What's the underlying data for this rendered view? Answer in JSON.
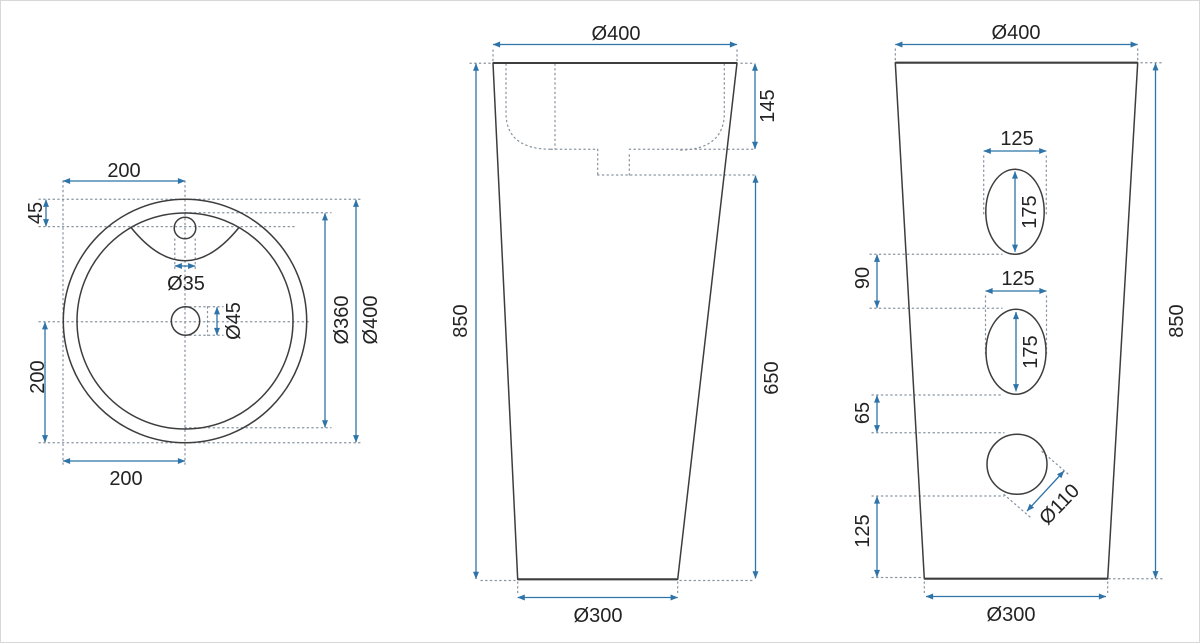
{
  "drawing": {
    "title": "Pedestal washbasin technical drawing, three views with dimensions (mm)",
    "colors": {
      "dimension_blue": "#2f74a8",
      "outline_dark": "#3d3d3d",
      "hidden_dotted_gray": "#8894a0",
      "text_black": "#232323",
      "background": "#ffffff"
    },
    "top_view": {
      "width_top": "200",
      "faucet_offset": "45",
      "faucet_hole": "Ø35",
      "drain_hole": "Ø45",
      "height_left": "200",
      "width_bottom": "200",
      "inner_diameter": "Ø360",
      "outer_diameter": "Ø400"
    },
    "front_view": {
      "top_diameter": "Ø400",
      "basin_depth": "145",
      "total_height": "850",
      "body_height": "650",
      "base_diameter": "Ø300"
    },
    "side_view": {
      "top_diameter": "Ø400",
      "hole1_width": "125",
      "hole1_height": "175",
      "gap_holes": "90",
      "hole2_width": "125",
      "hole2_height": "175",
      "gap_hole_drain": "65",
      "drain_hole": "Ø110",
      "base_offset": "125",
      "total_height": "850",
      "base_diameter": "Ø300"
    }
  }
}
